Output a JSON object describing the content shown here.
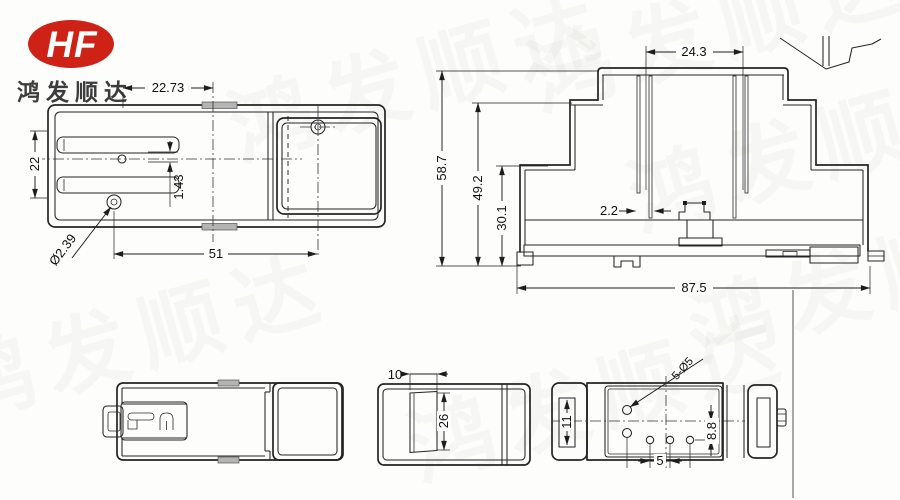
{
  "brand": {
    "logo_text": "HF",
    "logo_color": "#ce2217",
    "company_name": "鸿发顺达",
    "watermark_text": "鸿发顺达"
  },
  "dims": {
    "top_view": {
      "slot_span": "22.73",
      "slot_height": "22",
      "pin_offset": "1.43",
      "hole_diameter": "Ø2.39",
      "hole_spacing": "51"
    },
    "section_view": {
      "pin_span": "24.3",
      "overall_height": "58.7",
      "upper_height": "49.2",
      "lower_height": "30.1",
      "pin_width": "2.2",
      "overall_width": "87.5"
    },
    "side_view": {
      "cover_width": "10",
      "cover_height": "26"
    },
    "hole_view": {
      "hole_callout": "5-Ø5",
      "slot_length": "11",
      "row_offset": "8.8",
      "hole_pitch": "5"
    }
  }
}
